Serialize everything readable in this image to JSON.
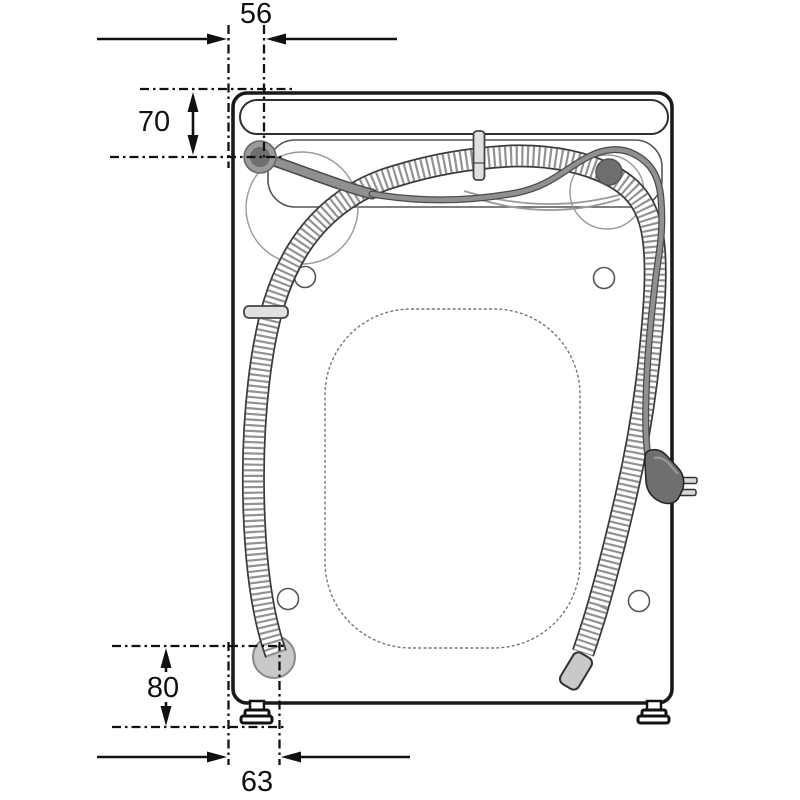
{
  "diagram": {
    "subject": "washing-machine-rear-view-installation-dimensions",
    "dimensions": {
      "top_offset": {
        "label": "56",
        "orientation": "horizontal",
        "position": "top"
      },
      "upper_height": {
        "label": "70",
        "orientation": "vertical",
        "position": "upper-left"
      },
      "lower_height": {
        "label": "80",
        "orientation": "vertical",
        "position": "lower-left"
      },
      "bottom_offset": {
        "label": "63",
        "orientation": "horizontal",
        "position": "bottom"
      }
    },
    "parts": [
      "cabinet",
      "top-handle-recess",
      "rear-top-panel",
      "back-recess-panel",
      "drain-hose",
      "drain-hose-end",
      "drain-pump",
      "power-cord",
      "power-plug",
      "left-port",
      "right-port",
      "hose-clip-left",
      "hose-clip-top",
      "screw-holes",
      "leveling-feet"
    ]
  },
  "colors": {
    "background": "#ffffff",
    "ink": "#1a1a1a",
    "panel_line": "#555555",
    "ghost_line": "#999999",
    "cord": "#909090",
    "pump": "#c9c9c9",
    "clip": "#e0e0e0",
    "hose_tip": "#c9c9c9",
    "plug": "#6f6f6f",
    "port": "#6f6f6f"
  }
}
